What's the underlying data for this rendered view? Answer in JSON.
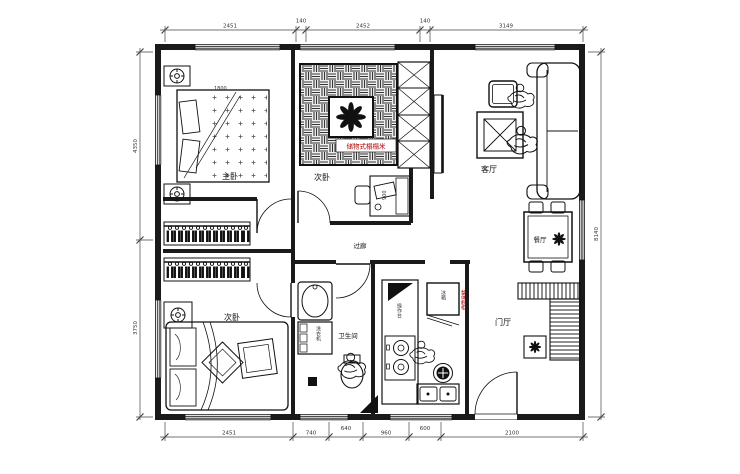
{
  "title": "apartment-floor-plan",
  "rooms": {
    "master_bedroom": "主卧",
    "bedroom_top": "次卧",
    "bedroom_bottom": "次卧",
    "living_room": "客厅",
    "dining_room": "餐厅",
    "corridor": "过廊",
    "bathroom": "卫生间",
    "foyer": "门厅"
  },
  "annotations": {
    "tatami_label": "储物式榻榻米",
    "fridge": "冰箱",
    "washing_machine": "洗衣机",
    "counter": "操作台",
    "cabinet_note": "整体橱柜",
    "bed_width": "1800",
    "desk_width": "900"
  },
  "dimensions": {
    "top": [
      "2451",
      "140",
      "2452",
      "140",
      "3149"
    ],
    "bottom": [
      "2451",
      "740",
      "640",
      "960",
      "600",
      "2100"
    ],
    "left": [
      "4350",
      "3750"
    ],
    "right": [
      "8140"
    ]
  },
  "icons": {
    "flower_icon": "8-petal plant flower",
    "lamp_icon": "circle lamp with tick marks",
    "hanger_icon": "clothes hanger bars",
    "person_icon": "sketched human figure"
  },
  "colors": {
    "line": "#1a1a1a",
    "accent_red": "#aa0000",
    "dim_text": "#444444"
  }
}
